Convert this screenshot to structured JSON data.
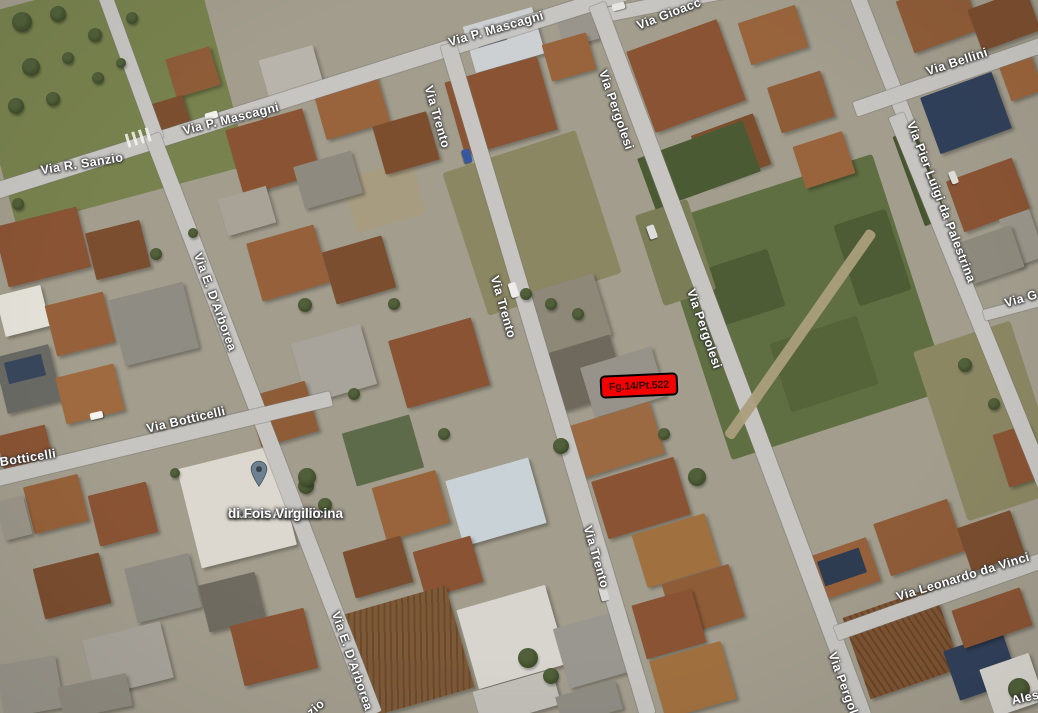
{
  "map": {
    "view_type": "satellite-aerial",
    "street_labels": [
      {
        "text": "Via R. Sanzio"
      },
      {
        "text": "Via P. Mascagni"
      },
      {
        "text": "Via P. Mascagni"
      },
      {
        "text": "Via Gioacc"
      },
      {
        "text": "Via Bellini"
      },
      {
        "text": "Via Trento"
      },
      {
        "text": "Via Trento"
      },
      {
        "text": "Via Trento"
      },
      {
        "text": "Via Pergolesi"
      },
      {
        "text": "Via Pergolesi"
      },
      {
        "text": "Via Pergolesi"
      },
      {
        "text": "Via Pier Luigi da Palestrina"
      },
      {
        "text": "Via G"
      },
      {
        "text": "Via Leonardo da Vinci"
      },
      {
        "text": "Via Botticelli"
      },
      {
        "text": "Botticelli"
      },
      {
        "text": "Via E. D'Arborea"
      },
      {
        "text": "Via E. D'Arborea"
      },
      {
        "text": "zio"
      },
      {
        "text": "Aless"
      }
    ],
    "poi": {
      "line1": "Nuova Autofficina",
      "line2": "di Fois Virgilio"
    },
    "parcel_marker": {
      "label": "Fg.14/Pt.522",
      "background": "#f40000",
      "border_color": "#000000",
      "text_color": "#330707"
    },
    "palette": {
      "road": "#c6c5c1",
      "ground": "#a29d8d",
      "field_green": "#5f6f41",
      "field_olive": "#8b8763",
      "roof_brown": "#8a5434",
      "roof_gray": "#8f8c84",
      "roof_white": "#d7d5ce",
      "tree_green": "#3f4c2b",
      "solar_blue": "#31405a",
      "label_text": "#ffffff",
      "pin_fill": "#6e8091"
    }
  }
}
